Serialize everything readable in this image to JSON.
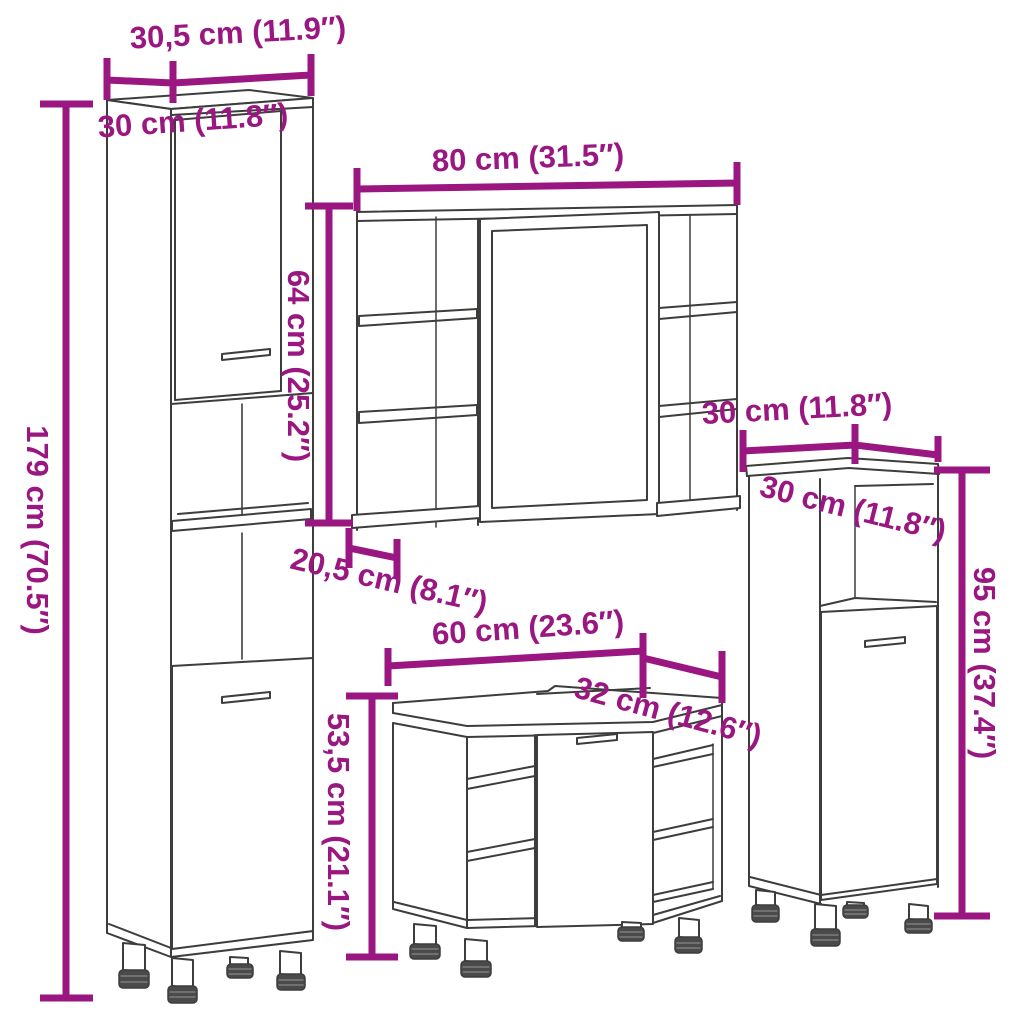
{
  "diagram": {
    "kind": "furniture-dimension-line-drawing",
    "colors": {
      "background": "#ffffff",
      "dimension_accent": "#9A1680",
      "line_art": "#3D3D3C",
      "foot_cap": "#4A4A4A"
    },
    "dimensions": {
      "tall_cabinet": {
        "width": "30,5 cm (11.9″)",
        "depth": "30 cm (11.8″)",
        "height": "179 cm (70.5″)"
      },
      "mirror_cabinet": {
        "width": "80 cm (31.5″)",
        "height": "64 cm (25.2″)",
        "depth": "20,5 cm (8.1″)"
      },
      "sink_cabinet": {
        "width": "60 cm (23.6″)",
        "depth": "32 cm (12.6″)",
        "height": "53,5 cm (21.1″)"
      },
      "side_cabinet": {
        "width": "30 cm (11.8″)",
        "depth": "30 cm (11.8″)",
        "height": "95 cm (37.4″)"
      }
    }
  }
}
